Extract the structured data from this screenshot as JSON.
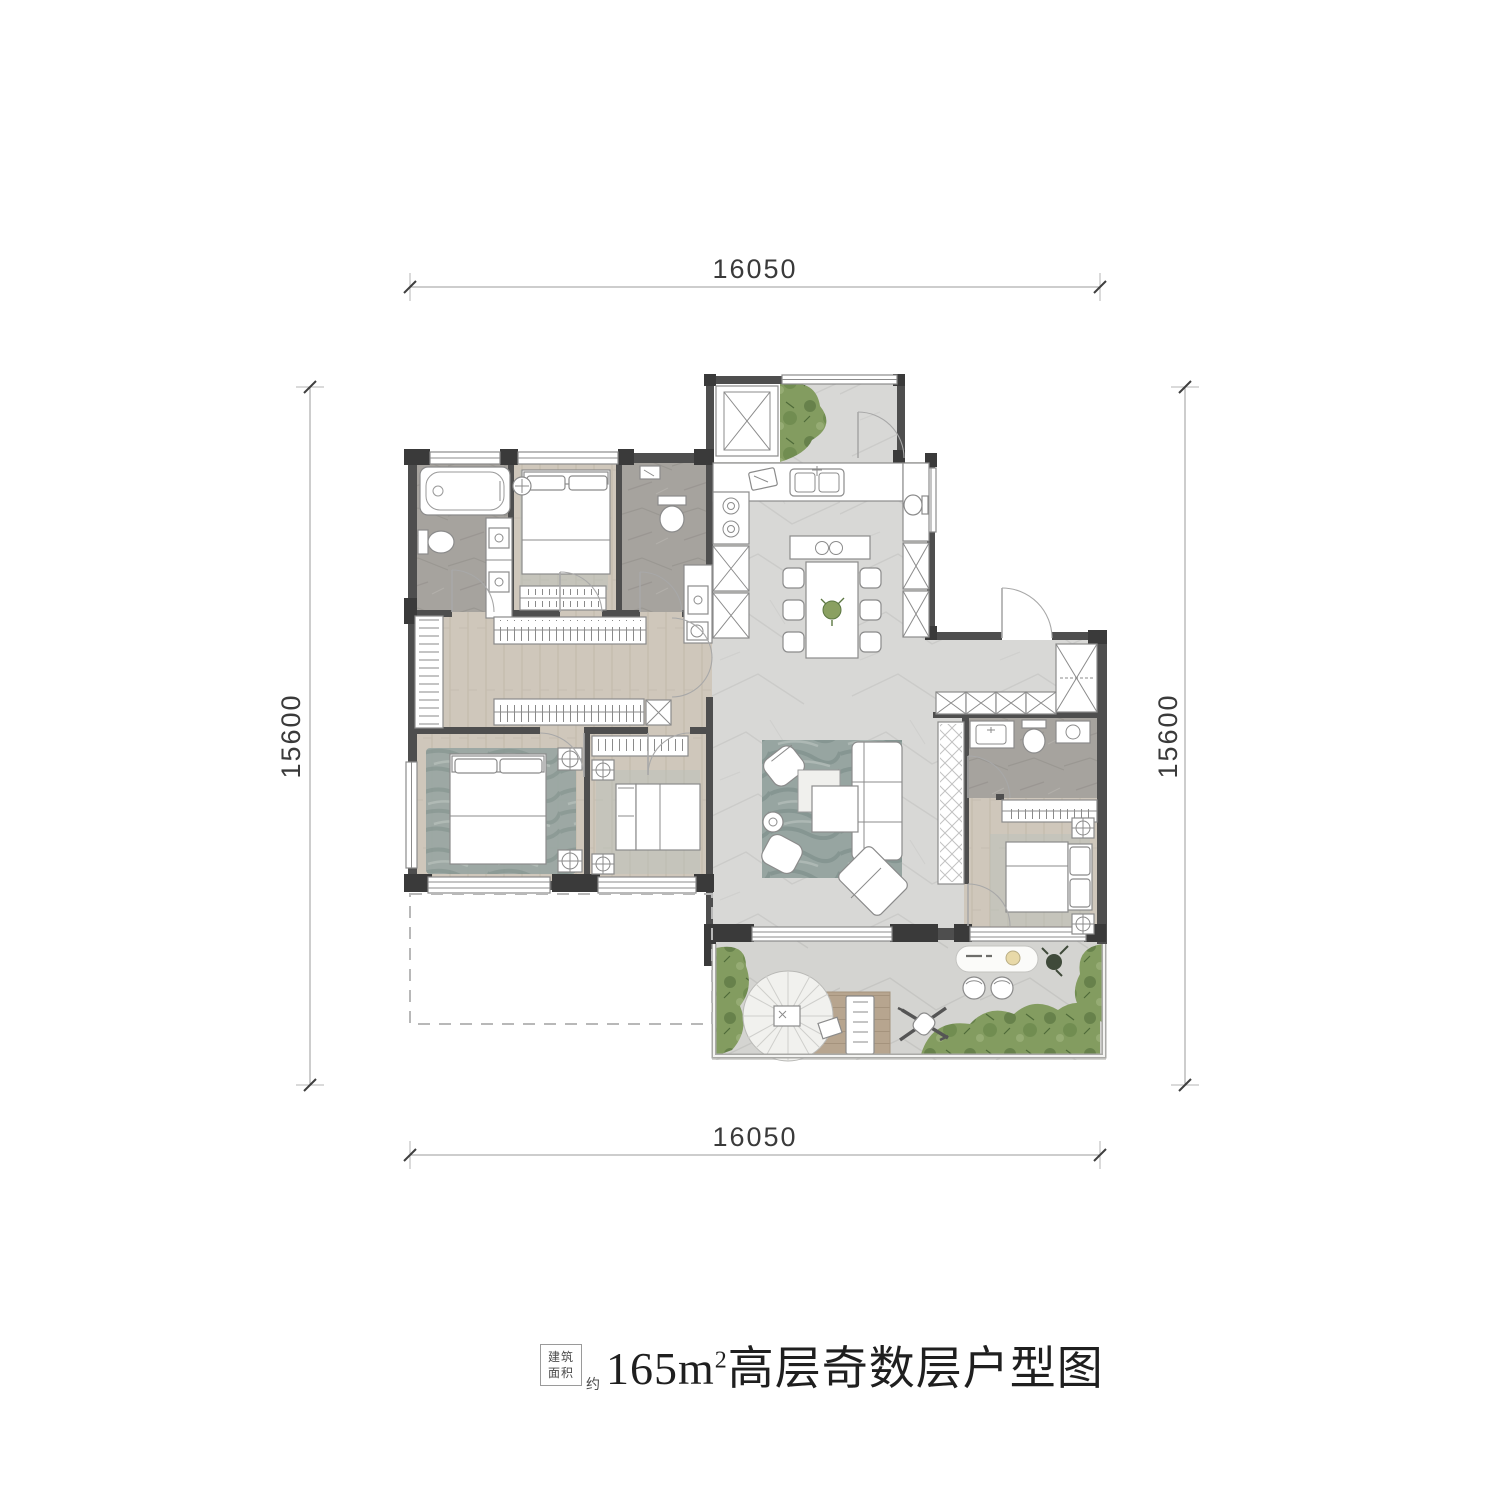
{
  "dimensions": {
    "top": "16050",
    "bottom": "16050",
    "left": "15600",
    "right": "15600"
  },
  "title": {
    "prefix_line1": "建筑",
    "prefix_line2": "面积",
    "approx": "约",
    "area": "165m",
    "area_sup": "2",
    "name": "高层奇数层户型图"
  },
  "colors": {
    "wall": "#4e4e4e",
    "post": "#3a3a3a",
    "wall_mid": "#8f8f8f",
    "stone_floor": "#d8d8d6",
    "terrace_floor": "#d4d4d1",
    "wood_floor": "#cfc7bb",
    "tile_floor": "#a6a39e",
    "rug": "#97a5a1",
    "rug_dark": "#76878a",
    "green": "#839c60",
    "green_dark": "#5c7742",
    "deck": "#b7a58f",
    "dim_text": "#3a3a3a",
    "title_text": "#1f1f1f"
  }
}
